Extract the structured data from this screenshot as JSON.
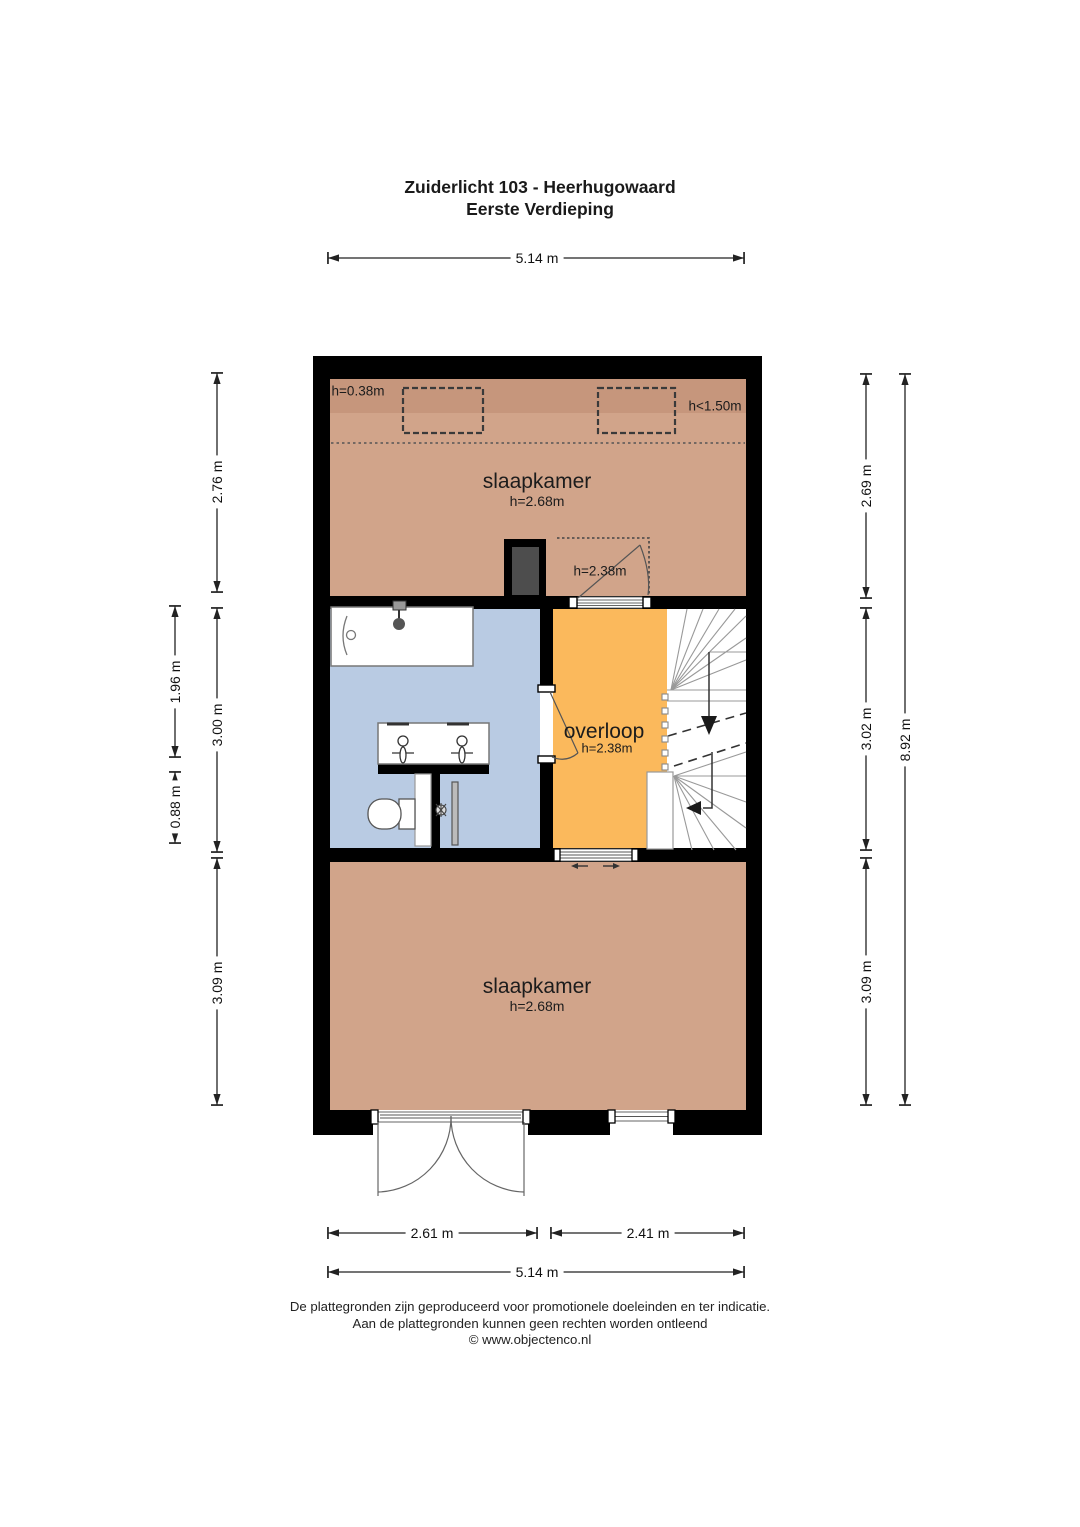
{
  "title": {
    "line1": "Zuiderlicht 103 - Heerhugowaard",
    "line2": "Eerste Verdieping"
  },
  "rooms": {
    "bedroom_top": {
      "label": "slaapkamer",
      "ceiling": "h=2.68m"
    },
    "bedroom_bottom": {
      "label": "slaapkamer",
      "ceiling": "h=2.68m"
    },
    "landing": {
      "label": "overloop",
      "ceiling": "h=2.38m"
    }
  },
  "annotations": {
    "knee_wall_height": "h=0.38m",
    "low_headroom": "h<1.50m",
    "door_height": "h=2.38m"
  },
  "dimensions": {
    "top_width": "5.14 m",
    "bottom_door_width": "2.61 m",
    "bottom_window_width": "2.41 m",
    "bottom_total_width": "5.14 m",
    "left_inner": [
      "2.76 m",
      "3.00 m",
      "3.09 m"
    ],
    "left_outer": [
      "1.96 m",
      "0.88 m"
    ],
    "right_inner": [
      "2.69 m",
      "3.02 m",
      "3.09 m"
    ],
    "right_total": "8.92 m"
  },
  "colors": {
    "wall": "#000000",
    "bedroom": "#d1a48a",
    "bedroom_low_band": "#c6967c",
    "bathroom": "#b9cbe3",
    "landing": "#fbb95c",
    "stairs": "#ffffff",
    "duct": "#4d4d4d"
  },
  "footer": {
    "line1": "De plattegronden zijn geproduceerd voor promotionele doeleinden en ter indicatie.",
    "line2": "Aan de plattegronden kunnen geen rechten worden ontleend",
    "line3": "© www.objectenco.nl"
  }
}
